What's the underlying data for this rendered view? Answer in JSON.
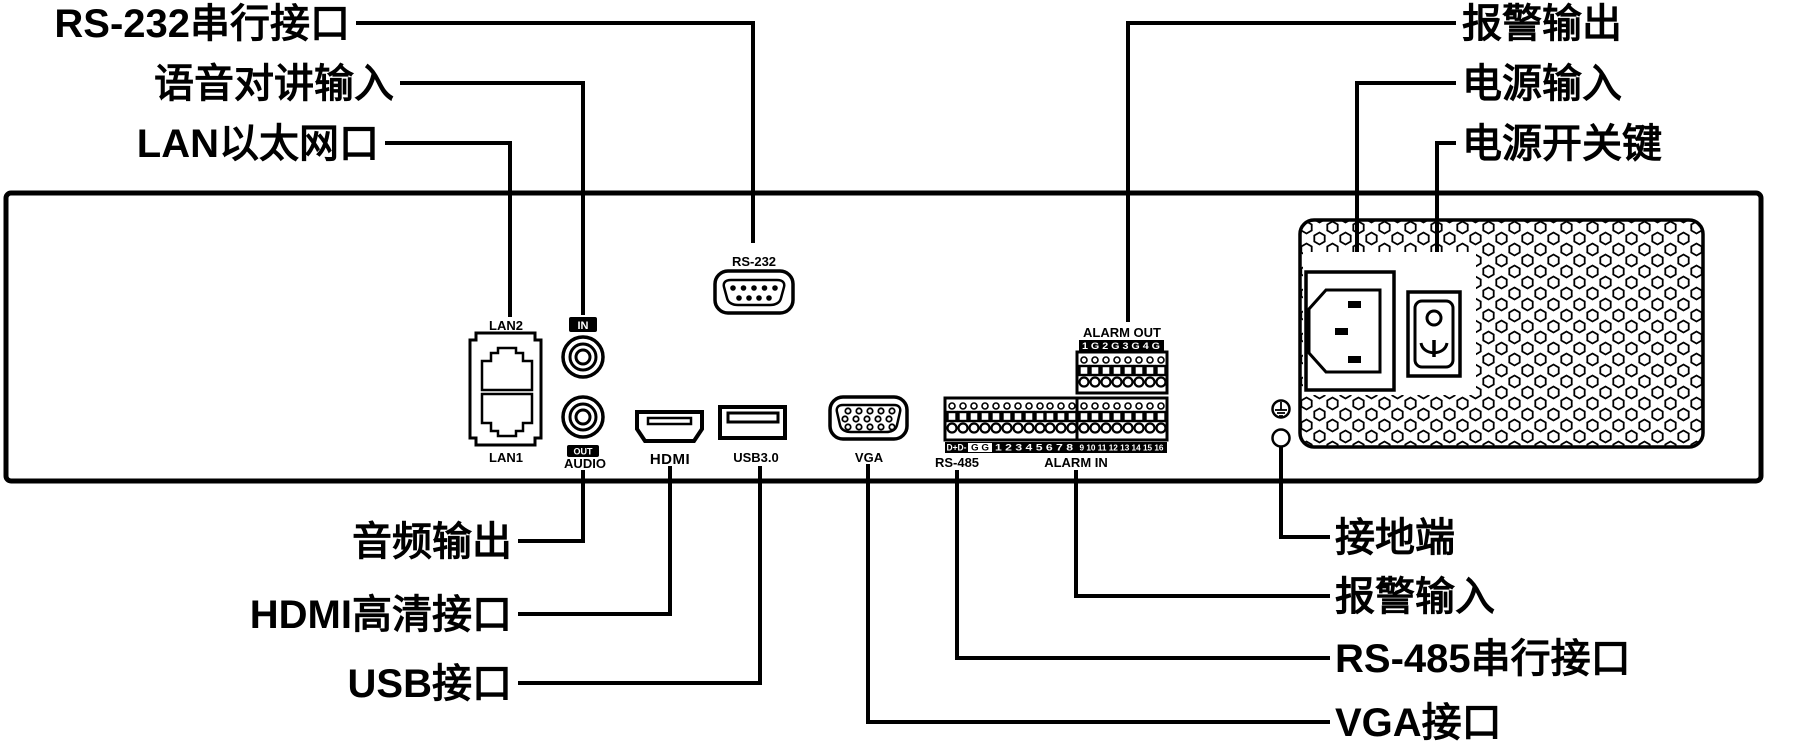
{
  "colors": {
    "line": "#000000",
    "background": "#ffffff"
  },
  "callouts": {
    "rs232": {
      "label": "RS-232串行接口"
    },
    "audio_in": {
      "label": "语音对讲输入"
    },
    "lan": {
      "label": "LAN以太网口"
    },
    "alarm_out": {
      "label": "报警输出"
    },
    "power_in": {
      "label": "电源输入"
    },
    "power_switch": {
      "label": "电源开关键"
    },
    "audio_out": {
      "label": "音频输出"
    },
    "hdmi": {
      "label": "HDMI高清接口"
    },
    "usb": {
      "label": "USB接口"
    },
    "ground": {
      "label": "接地端"
    },
    "alarm_in": {
      "label": "报警输入"
    },
    "rs485": {
      "label": "RS-485串行接口"
    },
    "vga": {
      "label": "VGA接口"
    }
  },
  "panel_labels": {
    "lan2": "LAN2",
    "lan1": "LAN1",
    "audio_in_badge": "IN",
    "audio_out_badge": "OUT",
    "audio": "AUDIO",
    "rs232": "RS-232",
    "hdmi_logo": "HDMI",
    "usb": "USB3.0",
    "vga": "VGA",
    "rs485": "RS-485",
    "alarm_in": "ALARM IN",
    "alarm_out": "ALARM OUT",
    "alarm_out_pins": "1 G 2 G 3 G 4 G",
    "rs485_pins": "D+D-",
    "rs485_gnd_pins": "G G",
    "alarm_in_pins_left": "1 2 3 4 5 6 7 8",
    "alarm_in_pins_right": "9 10 11 12 13 14 15 16"
  }
}
